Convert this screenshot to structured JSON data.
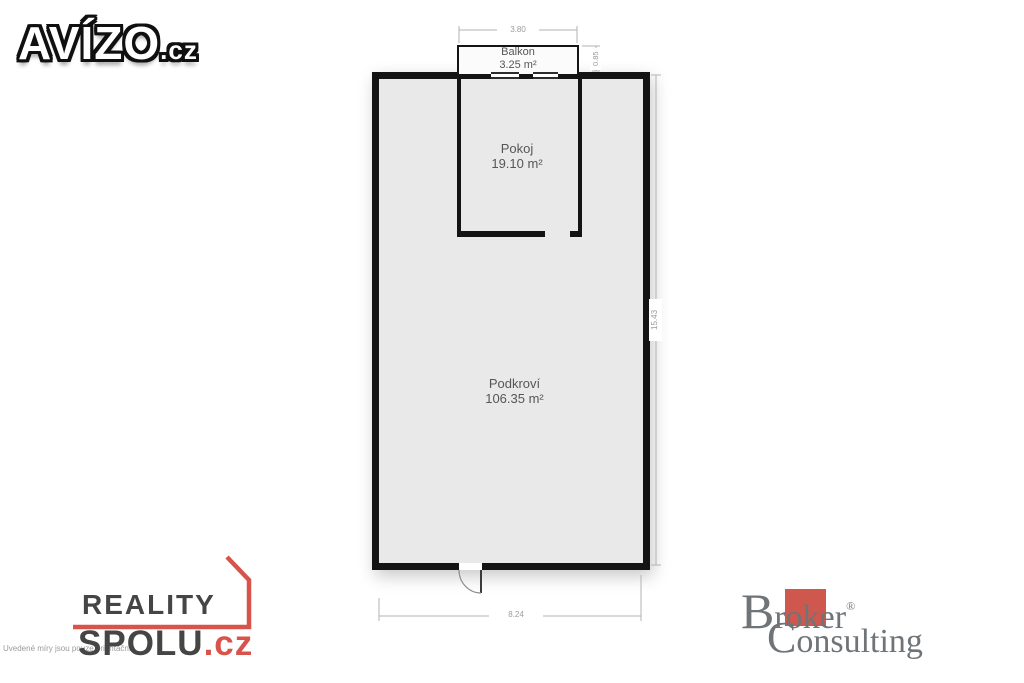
{
  "branding": {
    "avizo": {
      "name": "AVÍZO",
      "tld": ".cz"
    },
    "reality_spolu": {
      "line1": "REALITY",
      "line2": "SPOLU",
      "tld": ".cz"
    },
    "broker": {
      "line1_initial": "B",
      "line1_rest": "roker",
      "registered": "®",
      "line2_initial": "C",
      "line2_rest": "onsulting"
    }
  },
  "disclaimer": "Uvedené míry jsou pouze orientační",
  "floorplan": {
    "rooms": [
      {
        "name": "Balkon",
        "area": "3.25 m²"
      },
      {
        "name": "Pokoj",
        "area": "19.10 m²"
      },
      {
        "name": "Podkroví",
        "area": "106.35 m²"
      }
    ],
    "dimensions": {
      "balcony_width": "3.80",
      "balcony_depth": "0.85",
      "building_height": "15.43",
      "building_width": "8.24"
    }
  },
  "colors": {
    "wall": "#141414",
    "floor": "#e9e9e9",
    "dimension_gray": "#9b9b9b",
    "reality_red": "#d8544b",
    "broker_red": "#ce584e",
    "broker_gray": "#6f7478"
  }
}
